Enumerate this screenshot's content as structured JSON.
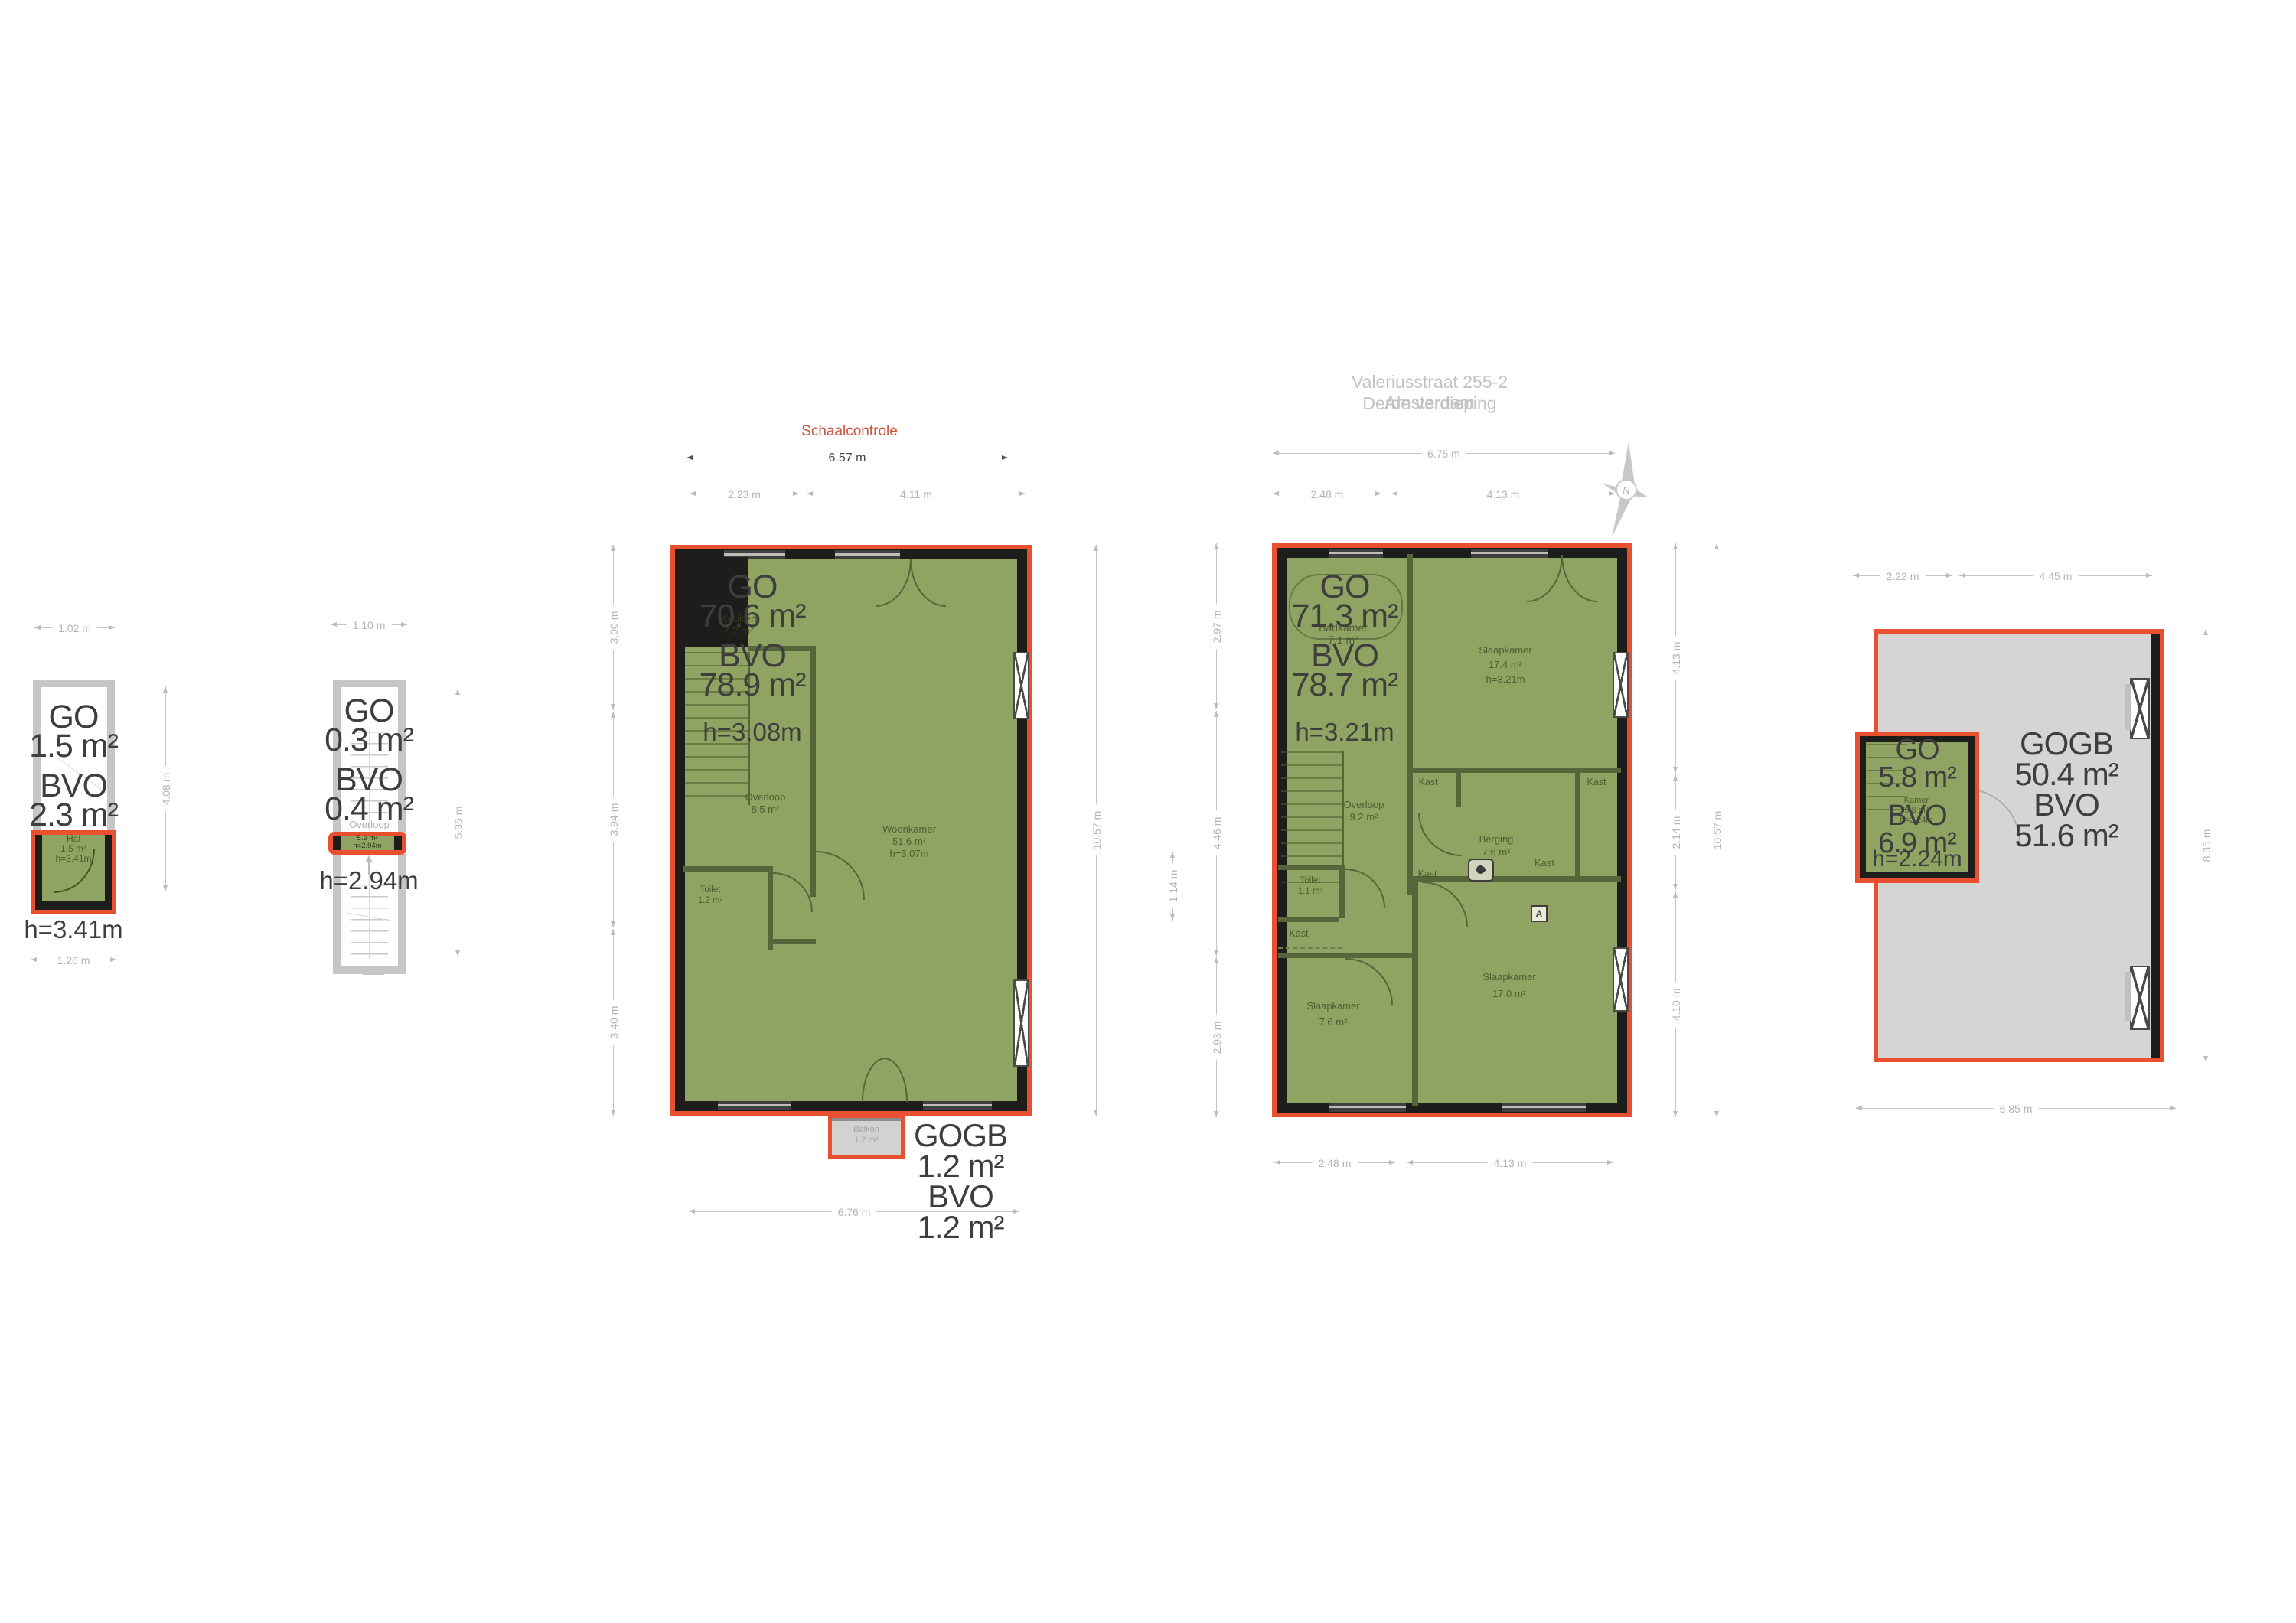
{
  "document": {
    "title_line1": "Valeriusstraat 255-2 Amsterdam",
    "title_line2": "Derde verdieping",
    "scale_check_label": "Schaalcontrole",
    "compass_letter": "N"
  },
  "colors": {
    "highlight_outline": "#e9502f",
    "measured_area_fill": "#8fa463",
    "wall": "#1d1d1b",
    "interior_wall": "#55663a",
    "light_structure": "#c7c6c4",
    "attic_fill": "#d6d5d3",
    "balcony_fill": "#d3d2d0",
    "dimension_gray": "#b5b4b2",
    "label_dark": "#3e3e3c",
    "scale_check_color": "#cb5742"
  },
  "plan_hal": {
    "dim_top": "1.02 m",
    "dim_bottom": "1.26 m",
    "dim_right": "4.08 m",
    "area_lines": [
      "GO",
      "1.5 m²",
      "BVO",
      "2.3 m²"
    ],
    "height_label": "h=3.41m",
    "room": {
      "name": "Hal",
      "area": "1.5 m²",
      "height": "h=3.41m"
    }
  },
  "plan_overloop": {
    "dim_top": "1.10 m",
    "dim_right": "5.36 m",
    "area_lines": [
      "GO",
      "0.3 m²",
      "BVO",
      "0.4 m²"
    ],
    "height_label": "h=2.94m",
    "room": {
      "name": "Overloop",
      "area": "5.9 m²",
      "height": "h=2.94m"
    }
  },
  "plan_main": {
    "scale_dim": "6.57 m",
    "dims_top": [
      "2.23 m",
      "4.11 m"
    ],
    "dims_left": [
      "3.00 m",
      "3.94 m",
      "3.40 m"
    ],
    "dim_right_total": "10.57 m",
    "dim_bottom": "6.76 m",
    "area_lines": [
      "GO",
      "70.6 m²",
      "BVO",
      "78.9 m²"
    ],
    "height_label": "h=3.08m",
    "rooms": {
      "keuken": {
        "name": "Keuken",
        "area": "7.2 m²"
      },
      "overloop": {
        "name": "Overloop",
        "area": "8.5 m²"
      },
      "woonkamer": {
        "name": "Woonkamer",
        "area": "51.6 m²",
        "height": "h=3.07m"
      },
      "toilet": {
        "name": "Toilet",
        "area": "1.2 m²"
      },
      "balkon": {
        "name": "Balkon",
        "area": "1.2 m²"
      }
    },
    "balcony_block": [
      "GOGB",
      "1.2 m²",
      "BVO",
      "1.2 m²"
    ]
  },
  "plan_derde": {
    "dim_top_total": "6.75 m",
    "dims_top": [
      "2.48 m",
      "4.13 m"
    ],
    "dims_left": [
      "2.97 m",
      "4.46 m",
      "2.93 m"
    ],
    "dim_left_inner": "1.14 m",
    "dims_right": [
      "4.13 m",
      "2.14 m",
      "4.10 m"
    ],
    "dim_right_total": "10.57 m",
    "dims_bottom": [
      "2.48 m",
      "4.13 m"
    ],
    "area_lines": [
      "GO",
      "71.3 m²",
      "BVO",
      "78.7 m²"
    ],
    "height_label": "h=3.21m",
    "kast_label": "Kast",
    "marker_a": "A",
    "rooms": {
      "badkamer": {
        "name": "Badkamer",
        "area": "7.1 m²"
      },
      "slaapkamer_voor": {
        "name": "Slaapkamer",
        "area": "17.4 m²",
        "height": "h=3.21m"
      },
      "overloop": {
        "name": "Overloop",
        "area": "9.2 m²"
      },
      "berging": {
        "name": "Berging",
        "area": "7.6 m²"
      },
      "toilet": {
        "name": "Toilet",
        "area": "1.1 m²"
      },
      "slaapkamer_klein": {
        "name": "Slaapkamer",
        "area": "7.6 m²"
      },
      "slaapkamer_achter": {
        "name": "Slaapkamer",
        "area": "17.0 m²"
      }
    }
  },
  "plan_attic": {
    "dims_top": [
      "2.22 m",
      "4.45 m"
    ],
    "dim_right": "8.35 m",
    "dim_bottom": "6.85 m",
    "area_lines": [
      "GO",
      "5.8 m²",
      "BVO",
      "6.9 m²"
    ],
    "height_label": "h=2.24m",
    "room": {
      "name": "Kamer",
      "area": "5.8 m²",
      "height": "h=2.24m"
    },
    "gogb_lines": [
      "GOGB",
      "50.4 m²",
      "BVO",
      "51.6 m²"
    ]
  }
}
